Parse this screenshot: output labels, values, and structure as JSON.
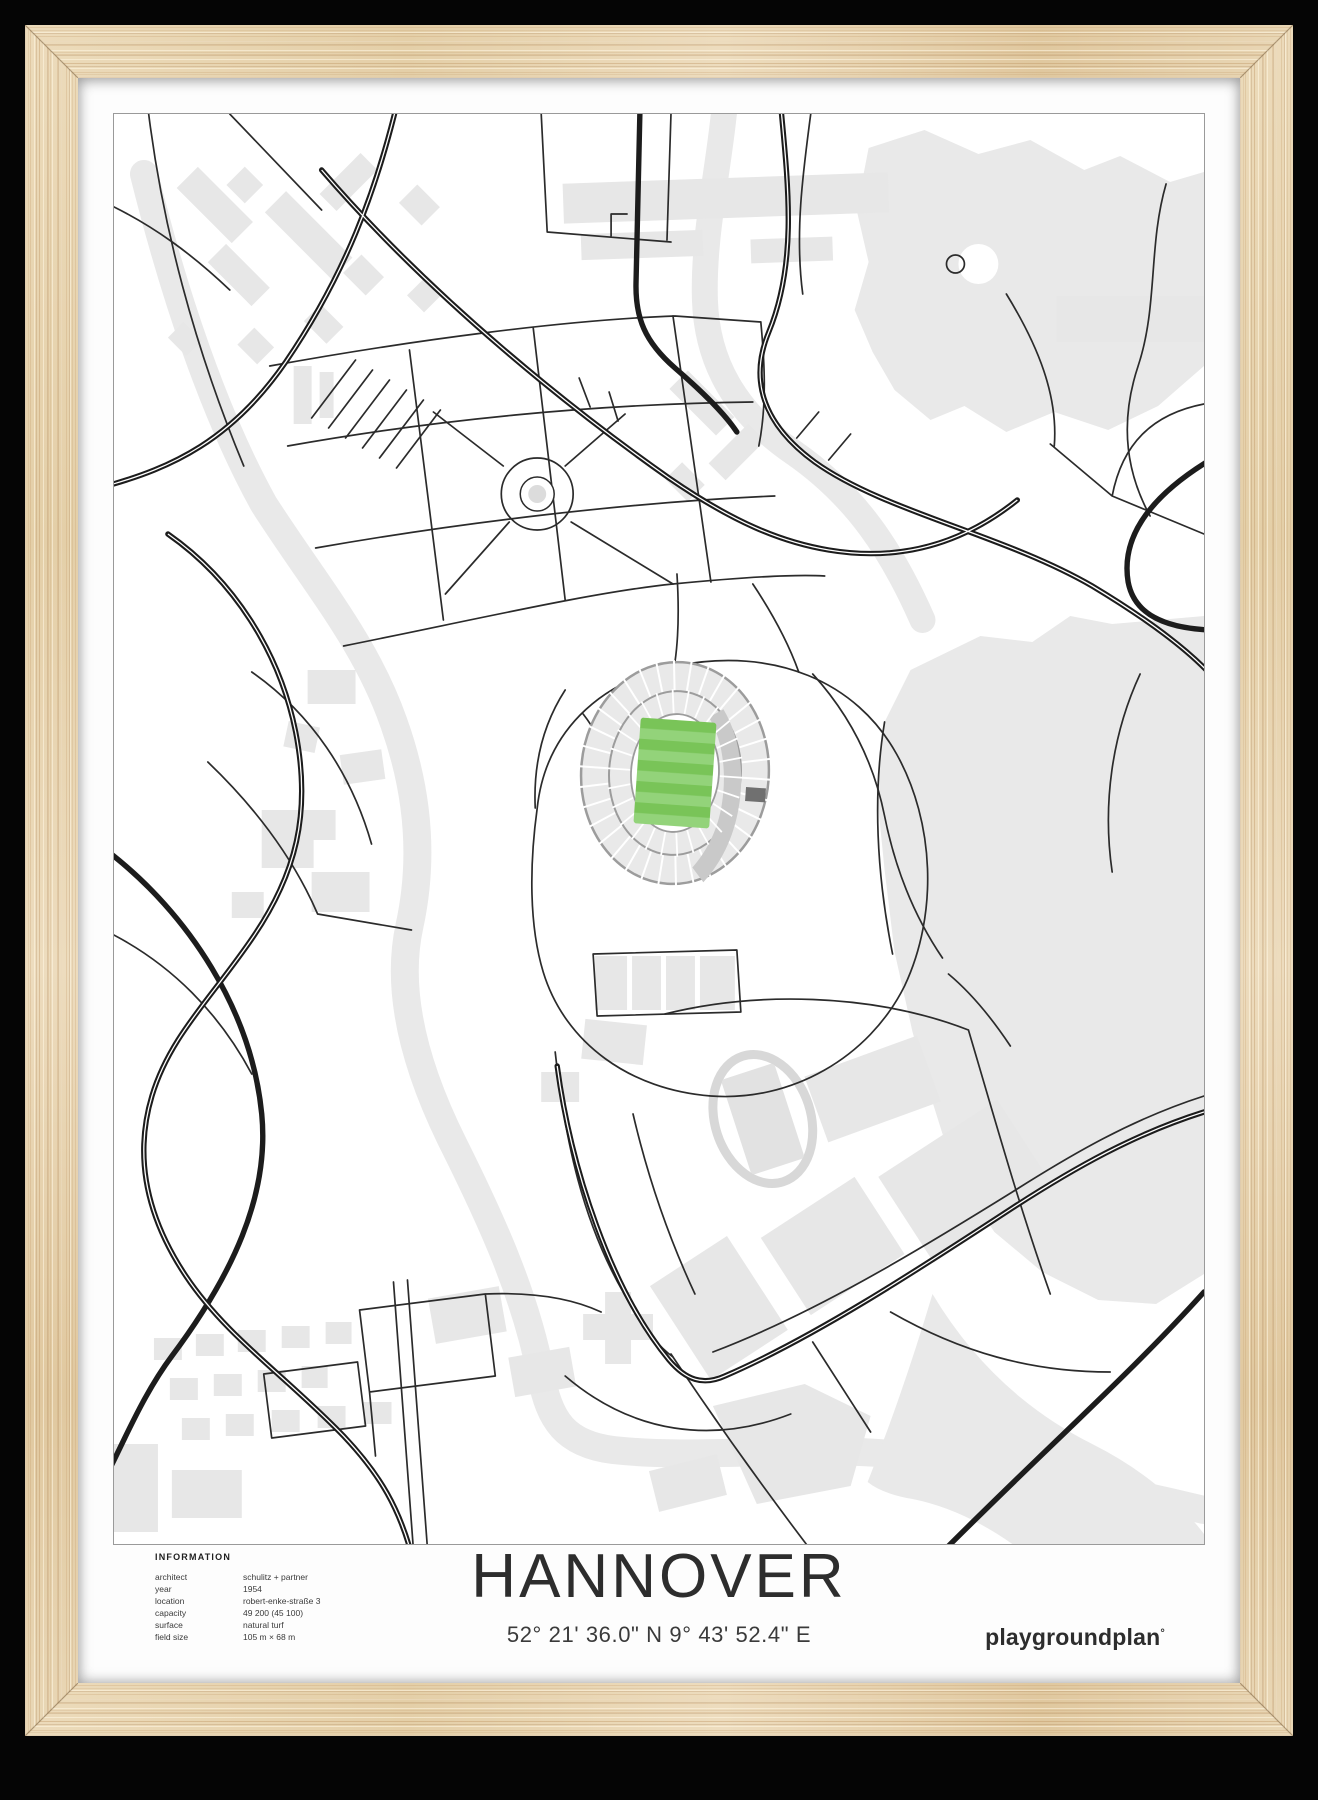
{
  "poster": {
    "title": "HANNOVER",
    "coordinates": "52° 21' 36.0\" N  9° 43' 52.4\" E",
    "brand": {
      "name": "playgroundplan",
      "mark": "°"
    },
    "info": {
      "heading": "INFORMATION",
      "rows": [
        {
          "label": "architect",
          "value": "schulitz + partner"
        },
        {
          "label": "year",
          "value": "1954"
        },
        {
          "label": "location",
          "value": "robert-enke-straße 3"
        },
        {
          "label": "capacity",
          "value": "49 200 (45 100)"
        },
        {
          "label": "surface",
          "value": "natural turf"
        },
        {
          "label": "field size",
          "value": "105 m × 68 m"
        }
      ]
    },
    "map": {
      "background": "#ffffff",
      "border_color": "#9a9a9a",
      "road_color": "#1c1c1c",
      "minor_road_color": "#2b2b2b",
      "water_color": "#e9e9e9",
      "building_color": "#e7e7e7",
      "stadium": {
        "stand_color": "#e9e9e9",
        "stand_outline": "#9c9c9c",
        "pitch_stripe_dark": "#79c458",
        "pitch_stripe_light": "#93d37a",
        "videowall_color": "#707070"
      }
    },
    "frame": {
      "wood_color": "#e8d5b2"
    }
  }
}
